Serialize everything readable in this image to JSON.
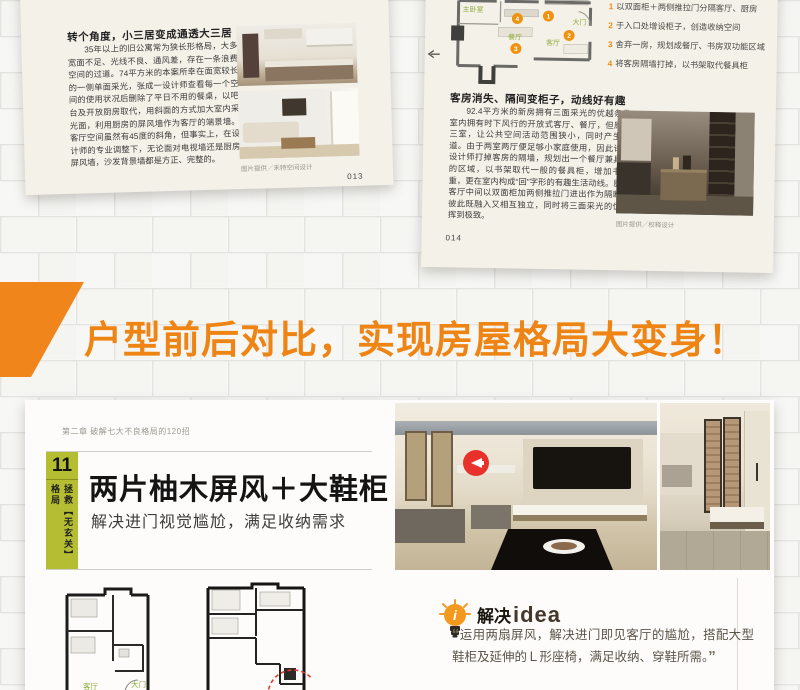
{
  "pages": {
    "left_page": {
      "title": "转个角度，小三居变成通透大三居",
      "body": "35年以上的旧公寓常为狭长形格局，大多宽面不足、光线不良、通风差，存在一条浪费空间的过道。74平方米的本案所幸在面宽较长的一侧单面采光，张成一设计师查看每一个空间的使用状况后删除了平日不用的餐桌，以吧台及开放厨房取代，用斜面的方式加大室内采光面，利用厨房的屏风墙作为客厅的端景墙。客厅空间虽然有45度的斜角，但事实上，在设计师的专业调整下，无论面对电视墙还是厨房屏风墙，沙发背景墙都是方正、完整的。",
      "caption": "图片提供／禾特空间设计",
      "page_number": "013"
    },
    "right_page": {
      "plan_labels": {
        "master": "主卧室",
        "dining": "餐厅",
        "living": "客厅",
        "door": "大门"
      },
      "callouts": [
        {
          "num": "1",
          "text": "以双面柜＋两侧推拉门分隔客厅、厨房"
        },
        {
          "num": "2",
          "text": "于入口处增设柜子，创造收纳空间"
        },
        {
          "num": "3",
          "text": "舍弃一房，规划成餐厅、书房双功能区域"
        },
        {
          "num": "4",
          "text": "将客房隔墙打掉，以书架取代餐具柜"
        }
      ],
      "heading": "客房消失、隔间变柜子，动线好有趣",
      "body": "92.4平方米的新房拥有三面采光的优越条件，室内拥有时下风行的开放式客厅、餐厅，但原本的三室，让公共空间活动范围狭小，同时产生了过道。由于两室两厅便足够小家庭使用，因此许宏彰设计师打掉客房的隔墙，规划出一个餐厅兼具书房的区域，以书架取代一般的餐具柜，增加书房比重，更在室内构成“回”字形的有趣生活动线。厨房与客厅中间以双面柜加两侧推拉门进出作为隔断，让彼此既融入又相互独立，同时将三面采光的优势发挥到极致。",
      "caption": "图片提供／权释设计",
      "page_number": "014"
    }
  },
  "banner": {
    "text": "户型前后对比，实现房屋格局大变身！"
  },
  "bottom_page": {
    "chapter": "第二章 破解七大不良格局的120招",
    "case_number": "11",
    "case_tag": "拯救【无玄关】格局",
    "title": "两片柚木屏风＋大鞋柜",
    "subtitle": "解决进门视觉尴尬，满足收纳需求",
    "plan_labels": {
      "living": "客厅",
      "door": "大门"
    },
    "idea": {
      "label_cn": "解决",
      "label_en": "idea",
      "open_quote": "“",
      "quote": "运用两扇屏风，解决进门即见客厅的尴尬，搭配大型鞋柜及延伸的Ｌ形座椅，满足收纳、穿鞋所需。",
      "close_quote": "”"
    }
  },
  "colors": {
    "accent_orange": "#f0861b",
    "banner_text": "#ee8414",
    "case_green": "#b5bd32",
    "badge_red": "#e8312a",
    "plan_label_green": "#8fae3f"
  }
}
